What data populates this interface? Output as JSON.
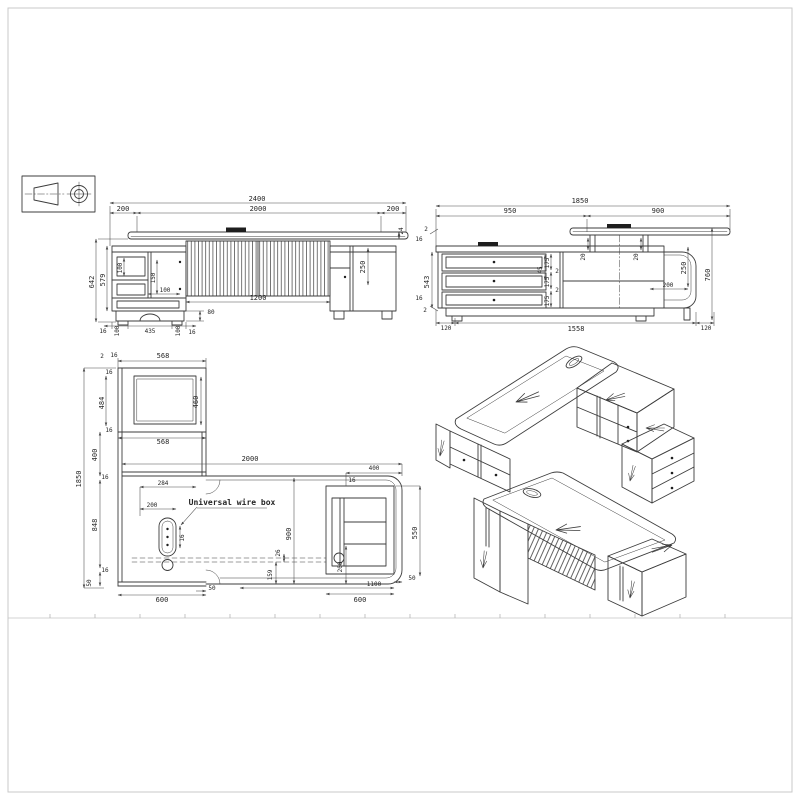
{
  "sheet": {
    "background": "#ffffff",
    "border_color": "#c9c9c9",
    "line_color": "#3c3c3c",
    "dim_color": "#4a4a4a"
  },
  "projection_symbol": {
    "icon": "first-angle-projection-symbol"
  },
  "front_view": {
    "dims": {
      "total_width": "2400",
      "overhang_left": "200",
      "body_width": "2000",
      "overhang_right": "200",
      "top_thickness": "24",
      "height_total": "642",
      "height_body": "579",
      "drawer_height": "100",
      "mid_panel": "150",
      "shelf_width": "100",
      "front_panel_width": "1200",
      "door_height": "250",
      "plinth_height": "80",
      "foot_inset_left": "16",
      "foot_left": "100",
      "foot_span": "435",
      "foot_right": "100",
      "foot_inset_right": "16"
    }
  },
  "side_view": {
    "dims": {
      "total_width": "1850",
      "left_width": "950",
      "return_width": "900",
      "top_gap": "2",
      "top_panel": "16",
      "body_height": "543",
      "bottom_panel": "16",
      "bottom_gap": "2",
      "drawer_1": "175",
      "gap_1": "2",
      "drawer_2": "175",
      "gap_2": "2",
      "drawer_3": "175",
      "divider": "45",
      "post_left": "20",
      "post_right": "20",
      "riser_height": "250",
      "total_height": "760",
      "shelf_depth": "200",
      "base_left": "120",
      "base_span": "1558",
      "base_right": "120"
    }
  },
  "plan_view": {
    "wire_box_label": "Universal wire box",
    "dims": {
      "square_width_top": "568",
      "square_inner": "460",
      "gap_2": "2",
      "wall_16": "16",
      "side_16_top": "16",
      "inner_depth": "484",
      "side_16_bottom": "16",
      "square_width_bottom": "568",
      "return_length": "1850",
      "seg_400": "400",
      "seg_16_a": "16",
      "seg_848": "848",
      "seg_16_b": "16",
      "seg_50": "50",
      "desk_length": "2000",
      "wire_box_offset": "284",
      "wire_box_span": "200",
      "wire_box_side": "16",
      "desk_depth": "900",
      "panel_offset": "26",
      "front_inset": "159",
      "pedestal_inner": "200",
      "side_overhang": "50",
      "return_width": "600",
      "pedestal_width": "600",
      "pedestal_span": "1100",
      "right_gap": "50",
      "pedestal_depth": "550",
      "top_seg_400": "400",
      "top_seg_16": "16"
    }
  }
}
